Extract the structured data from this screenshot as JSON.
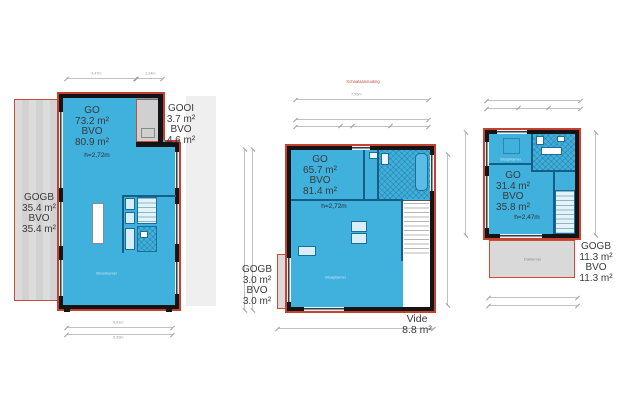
{
  "title": {
    "scale_note": "Schaalaanduiding"
  },
  "colors": {
    "go_fill": "#40b0dd",
    "outline_red": "#c74130",
    "wall_black": "#141414",
    "gogb_fill": "#d9d9d9"
  },
  "plans": {
    "first": {
      "go": {
        "code": "GO",
        "area": "73.2 m²",
        "bvo": "BVO",
        "bvo_area": "80.9 m²",
        "height": "h=2,72m"
      },
      "gooi": {
        "code": "GOOI",
        "area": "3.7 m²",
        "bvo": "BVO",
        "bvo_area": "4.6 m²"
      },
      "gogb": {
        "code": "GOGB",
        "area": "35.4 m²",
        "bvo": "BVO",
        "bvo_area": "35.4 m²"
      },
      "room": "Woonkamer",
      "dims": {
        "top_a": "4,47m",
        "top_b": "1,34m",
        "bottom_a": "5,81m",
        "bottom_b": "5,99m"
      }
    },
    "second": {
      "go": {
        "code": "GO",
        "area": "65.7 m²",
        "bvo": "BVO",
        "bvo_area": "81.4 m²",
        "height": "h=2,72m"
      },
      "gogb": {
        "code": "GOGB",
        "area": "3.0 m²",
        "bvo": "BVO",
        "bvo_area": "3.0 m²"
      },
      "vide": {
        "code": "Vide",
        "area": "8.8 m²"
      },
      "room": "Slaapkamer",
      "dims": {
        "top_a": "7,95m"
      }
    },
    "third": {
      "go": {
        "code": "GO",
        "area": "31.4 m²",
        "bvo": "BVO",
        "bvo_area": "35.8 m²",
        "height": "h=2,47m"
      },
      "gogb": {
        "code": "GOGB",
        "area": "11.3 m²",
        "bvo": "BVO",
        "bvo_area": "11.3 m²"
      },
      "room": "Slaapkamer",
      "terrace": "Dakterras"
    }
  }
}
